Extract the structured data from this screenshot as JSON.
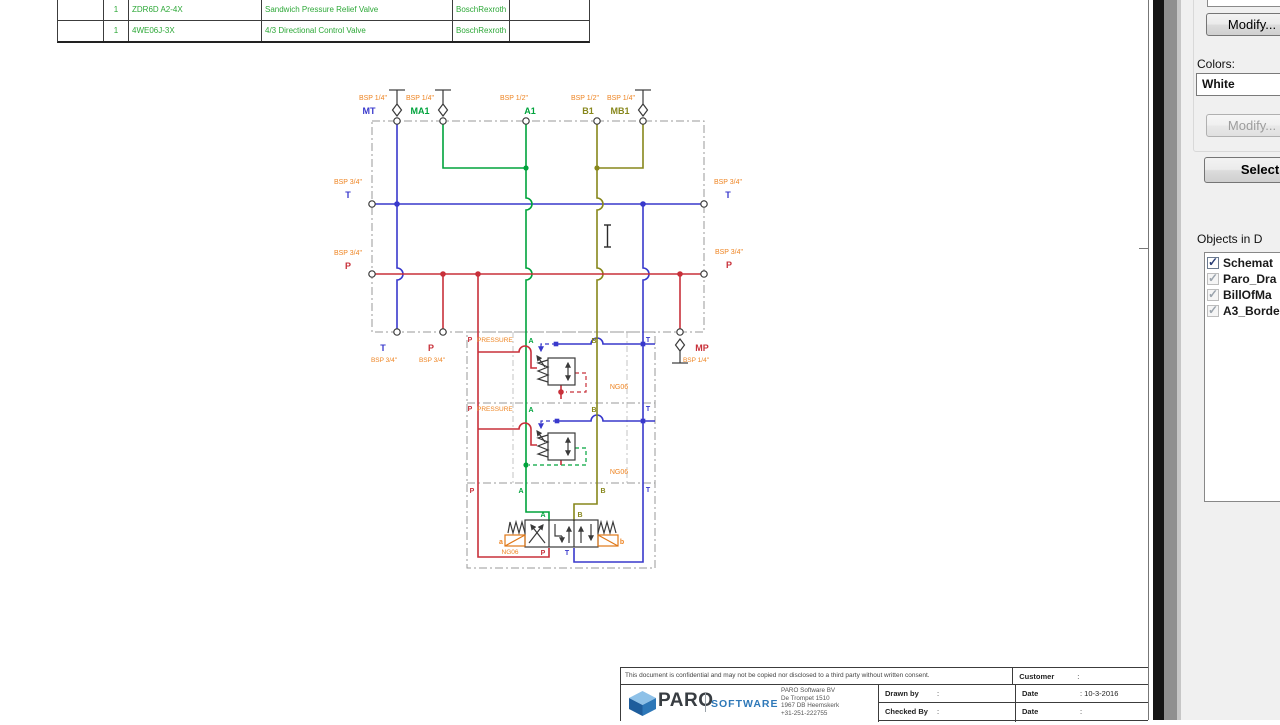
{
  "colors": {
    "schematic_green": "#00a33c",
    "schematic_blue": "#3939cc",
    "schematic_red": "#c8303a",
    "schematic_olive": "#87871c",
    "schematic_orange": "#ee8422",
    "table_text_green": "#2da838",
    "dash_gray": "#9a9a9a",
    "logo_blue": "#2e78b8",
    "logo_dark": "#383d42",
    "panel_bg": "#f0f0f0"
  },
  "bom_table": {
    "rows": [
      {
        "qty": "1",
        "model": "ZDR6D A2-4X",
        "description": "Sandwich Pressure Relief Valve",
        "manufacturer": "BoschRexroth"
      },
      {
        "qty": "1",
        "model": "4WE06J-3X",
        "description": "4/3 Directional Control Valve",
        "manufacturer": "BoschRexroth"
      }
    ]
  },
  "schematic": {
    "top": [
      {
        "bsp": "BSP 1/4\"",
        "name": "MT"
      },
      {
        "bsp": "BSP 1/4\"",
        "name": "MA1"
      },
      {
        "bsp": "BSP 1/2\"",
        "name": "A1"
      },
      {
        "bsp": "BSP 1/2\"",
        "name": "B1"
      },
      {
        "bsp": "BSP 1/4\"",
        "name": "MB1"
      }
    ],
    "left": [
      {
        "bsp": "BSP 3/4\"",
        "name": "T"
      },
      {
        "bsp": "BSP 3/4\"",
        "name": "P"
      }
    ],
    "right": [
      {
        "bsp": "BSP 3/4\"",
        "name": "T"
      },
      {
        "bsp": "BSP 3/4\"",
        "name": "P"
      }
    ],
    "bottom": [
      {
        "name": "T",
        "bsp": "BSP 3/4\""
      },
      {
        "name": "P",
        "bsp": "BSP 3/4\""
      },
      {
        "name": "MP",
        "bsp": "BSP 1/4\""
      }
    ],
    "s1": {
      "p": "P",
      "pressure": "PRESSURE",
      "a": "A",
      "b": "B",
      "t": "T",
      "size": "NG06"
    },
    "s2": {
      "p": "P",
      "pressure": "PRESSURE",
      "a": "A",
      "b": "B",
      "t": "T",
      "size": "NG06"
    },
    "s3": {
      "p": "P",
      "a": "A",
      "b": "B",
      "t": "T",
      "size": "NG06",
      "sol_a": "a",
      "sol_b": "b",
      "va": "A",
      "vb": "B",
      "vp": "P",
      "vt": "T"
    }
  },
  "title_block": {
    "confidential": "This document is confidential and may not be copied nor disclosed to a third party without written consent.",
    "customer_label": "Customer",
    "customer_value": ":",
    "drawn_by_label": "Drawn by",
    "drawn_by_value": ":",
    "checked_by_label": "Checked By",
    "checked_by_value": ":",
    "date1_label": "Date",
    "date1_value": ": 10-3-2016",
    "date2_label": "Date",
    "date2_value": ":",
    "logo_text": "PARO",
    "logo_sub": "SOFTWARE",
    "company": [
      "PARO Software BV",
      "De Trompet 1510",
      "1967 DB Heemskerk",
      "+31-251-222755"
    ]
  },
  "side_panel": {
    "modify_button": "Modify...",
    "colors_label": "Colors:",
    "color_value": "White",
    "modify_disabled_button": "Modify...",
    "select_button": "Select",
    "objects_label": "Objects in D",
    "objects": [
      {
        "label": "Schemat",
        "checked": true,
        "enabled": true
      },
      {
        "label": "Paro_Dra",
        "checked": true,
        "enabled": false
      },
      {
        "label": "BillOfMa",
        "checked": true,
        "enabled": false
      },
      {
        "label": "A3_Borde",
        "checked": true,
        "enabled": false
      }
    ]
  }
}
